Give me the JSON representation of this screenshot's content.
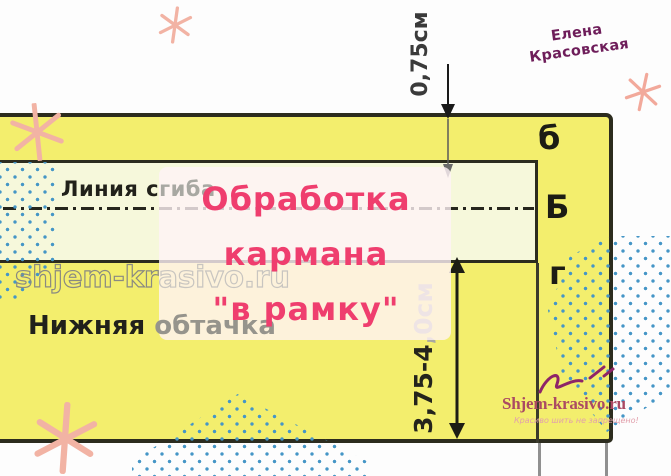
{
  "author": {
    "line1": "Елена",
    "line2": "Красовская"
  },
  "title": {
    "line1": "Обработка",
    "line2": "кармана",
    "line3": "\"в рамку\""
  },
  "diagram": {
    "fold_label": {
      "dark": "Линия с",
      "light": "гиба"
    },
    "watermark": {
      "dark": "shjem-kr",
      "light": "asivo.ru"
    },
    "facing_label": {
      "dark": "Нижняя",
      "light": "обтачка"
    },
    "section_letters": {
      "top": "б",
      "middle": "Б",
      "bottom": "г"
    },
    "measure_top": "0,75см",
    "measure_side": {
      "dark": "3,75-4",
      "light": ",0см"
    }
  },
  "brand": {
    "site": "Shjem-krasivo.ru",
    "slogan": "Красиво шить не запрещено!"
  },
  "colors": {
    "accent_pink": "#ef3e6e",
    "author_purple": "#6e1d5a",
    "fabric_yellow": "#f3ee6d",
    "stripe_cream": "#f6f8db",
    "outline_dark": "#2c2c1e",
    "dot_blue": "#4596c6",
    "asterisk_salmon": "#f2b3a4",
    "brand_rose": "#ab4a63",
    "slogan_pink": "#e2a0ac",
    "watermark_gray": "#8a8a82",
    "watermark_light": "#c8c5c0"
  }
}
